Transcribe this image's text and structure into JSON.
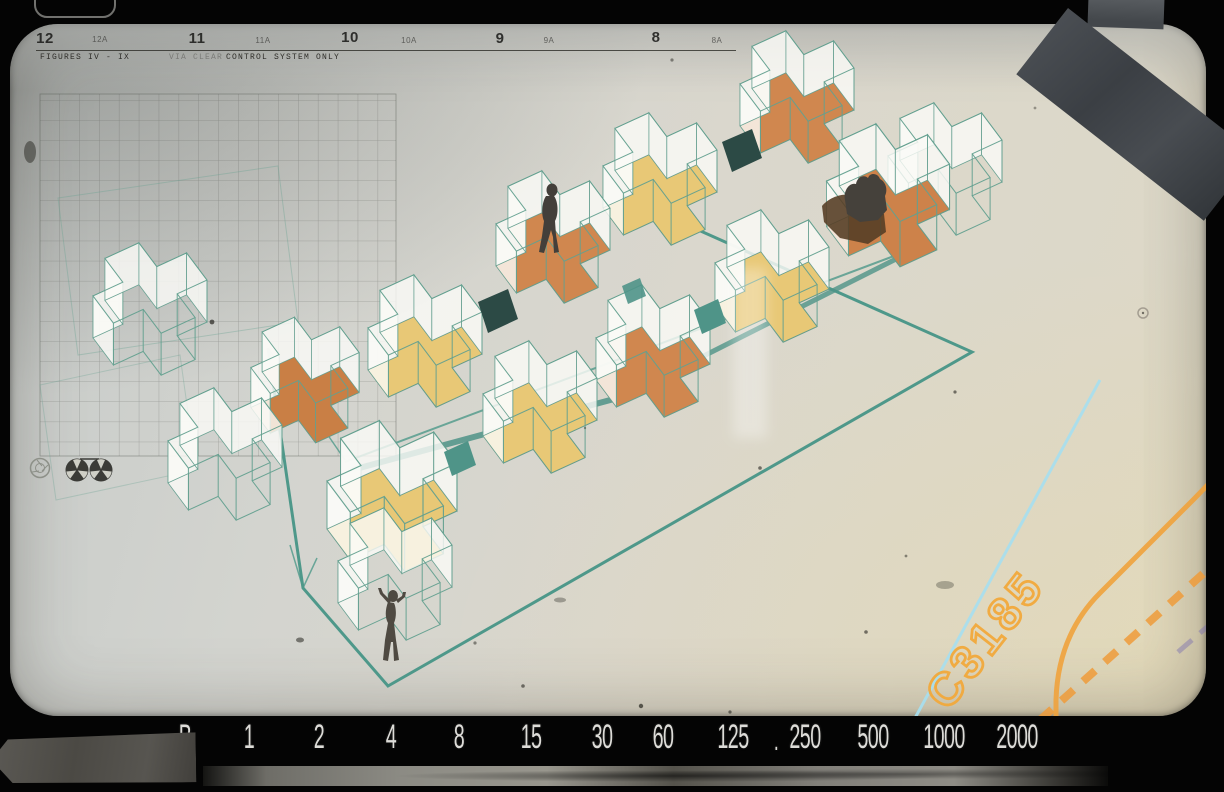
{
  "film_edge": {
    "frames": [
      {
        "label": "12"
      },
      {
        "label": "12A"
      },
      {
        "label": "11"
      },
      {
        "label": "11A"
      },
      {
        "label": "10"
      },
      {
        "label": "10A"
      },
      {
        "label": "9"
      },
      {
        "label": "9A"
      },
      {
        "label": "8"
      },
      {
        "label": "8A"
      }
    ],
    "caption": {
      "left": "FIGURES IV - IX",
      "mid": "VIA CLEAR",
      "right": "CONTROL SYSTEM ONLY"
    },
    "edge_code": "C3185"
  },
  "shutter_dial": {
    "stops": [
      "B",
      "1",
      "2",
      "4",
      "8",
      "15",
      "30",
      "60",
      "125",
      "250",
      "500",
      "1000",
      "2000"
    ],
    "separator": "."
  },
  "icons": {
    "aperture": "aperture-icon",
    "reel_left": "film-reel-icon",
    "reel_right": "film-reel-icon"
  },
  "palette": {
    "photo_paper": "#d7d5c9",
    "teal_outline": "#63a08f",
    "teal_platform": "#4e988a",
    "teal_panel": "#4f9488",
    "dark_teal_panel": "#2c4a45",
    "orange_plate": "#d0874f",
    "yellow_plate": "#e8c876",
    "cyan_line": "#a6dff0",
    "orange_marking": "#f2a93c",
    "tape_gray": "#46494d"
  }
}
